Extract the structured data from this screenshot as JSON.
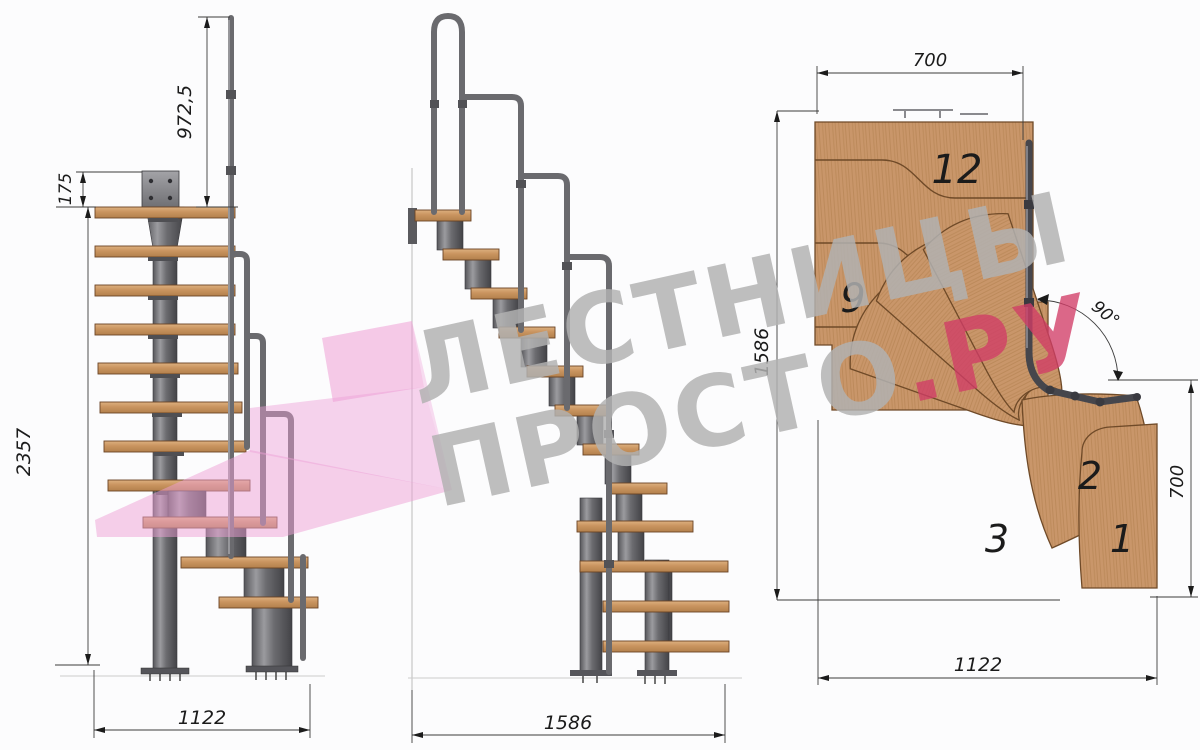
{
  "canvas": {
    "background": "#fcfcfd",
    "dimension_line_color": "#3c3c3c",
    "dimension_text_color": "#1b1b1b",
    "wood_color": "#c9966a",
    "metal_color": "#6a6a6e"
  },
  "watermark": {
    "line1": "ЛЕСТНИЦЫ",
    "line2_gray": "ПРОСТО",
    "line2_red": ".РУ",
    "gray_color": "#b1b1b1",
    "red_color": "#d13c67",
    "arrow_pink": "#ee9fd6"
  },
  "views": {
    "side_elevation": {
      "dims": {
        "handrail_height": "972,5",
        "mount_plate": "175",
        "total_height": "2357",
        "run_length": "1122"
      }
    },
    "front_elevation": {
      "dims": {
        "run_length": "1586"
      }
    },
    "plan": {
      "dims": {
        "landing_width": "700",
        "overall_length": "1586",
        "turn_angle": "90°",
        "exit_width": "700",
        "overall_width": "1122"
      },
      "step_numbers": {
        "n12": "12",
        "n9": "9",
        "n3": "3",
        "n2": "2",
        "n1": "1"
      }
    }
  }
}
